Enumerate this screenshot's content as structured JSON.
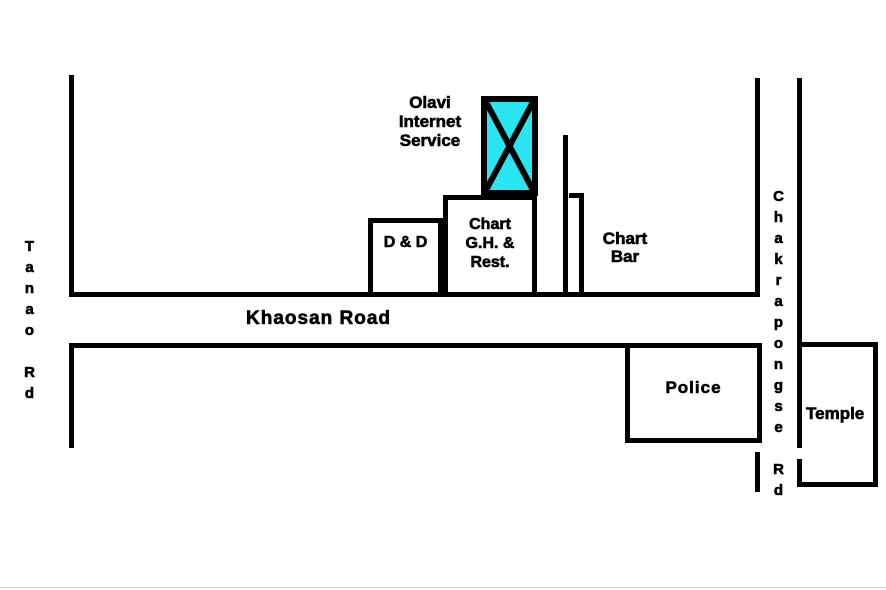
{
  "colors": {
    "line": "#000000",
    "highlight": "#29e5f2",
    "background": "#ffffff",
    "text": "#000000"
  },
  "roads": {
    "khaosan": {
      "label": "Khaosan Road"
    },
    "tanao": {
      "label": "Tanao Rd"
    },
    "chakrapongse": {
      "label": "Chakrapongse Rd"
    }
  },
  "places": {
    "olavi": {
      "lines": [
        "Olavi",
        "Internet",
        "Service"
      ]
    },
    "dd": {
      "label": "D & D"
    },
    "chart_gh": {
      "lines": [
        "Chart",
        "G.H. &",
        "Rest."
      ]
    },
    "chart_bar": {
      "lines": [
        "Chart",
        "Bar"
      ]
    },
    "police": {
      "label": "Police"
    },
    "temple": {
      "label": "Temple"
    }
  }
}
